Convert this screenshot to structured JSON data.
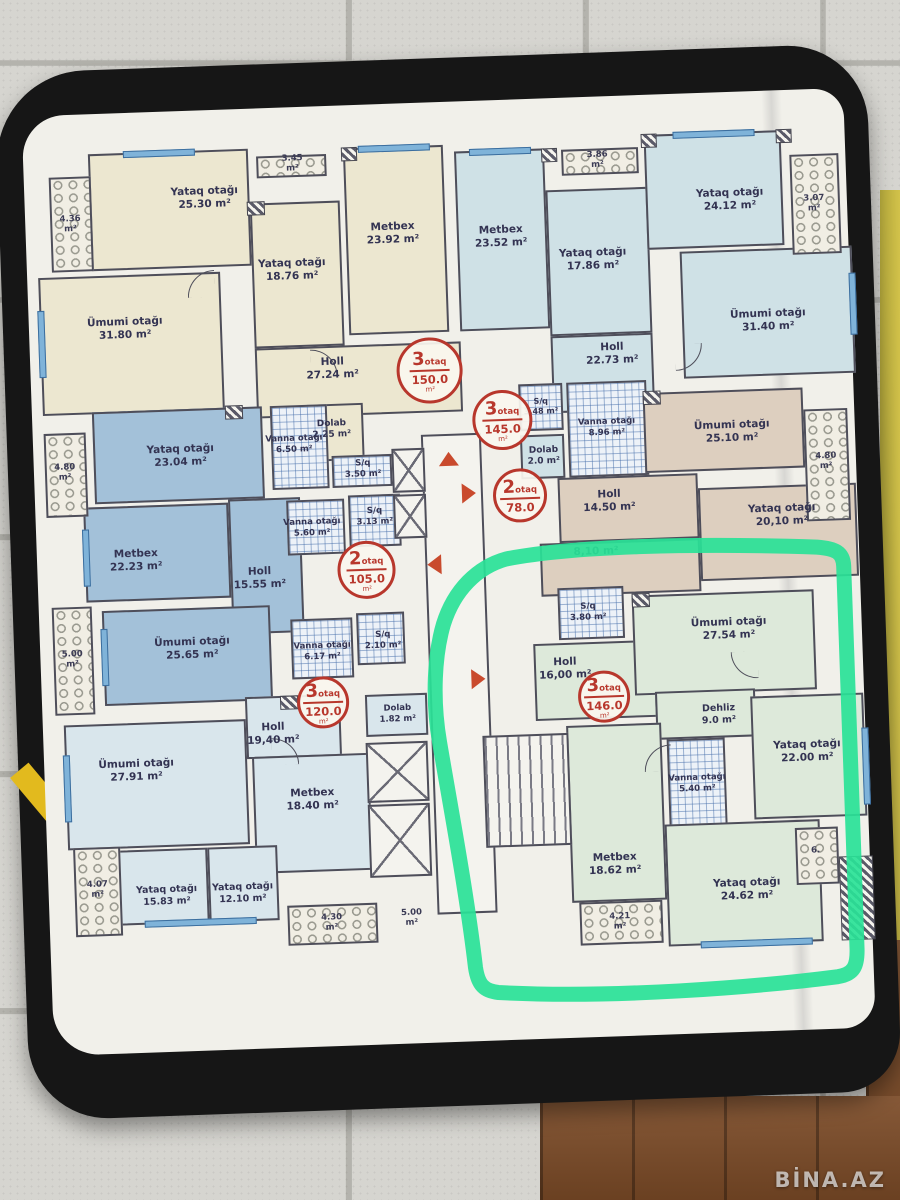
{
  "photo": {
    "watermark": "BİNA.AZ"
  },
  "units": [
    {
      "rooms": "3",
      "suffix": "otaq",
      "area": "150.0",
      "unit": "m²"
    },
    {
      "rooms": "3",
      "suffix": "otaq",
      "area": "145.0",
      "unit": "m²"
    },
    {
      "rooms": "2",
      "suffix": "otaq",
      "area": "78.0",
      "unit": ""
    },
    {
      "rooms": "2",
      "suffix": "otaq",
      "area": "105.0",
      "unit": "m²"
    },
    {
      "rooms": "3",
      "suffix": "otaq",
      "area": "120.0",
      "unit": "m²"
    },
    {
      "rooms": "3",
      "suffix": "otaq",
      "area": "146.0",
      "unit": "m²"
    }
  ],
  "rooms": [
    {
      "name": "Yataq otağı",
      "area": "25.30 m²"
    },
    {
      "name": "Ümumi otağı",
      "area": "31.80 m²"
    },
    {
      "name": "Yataq otağı",
      "area": "18.76 m²"
    },
    {
      "name": "Metbex",
      "area": "23.92 m²"
    },
    {
      "name": "Holl",
      "area": "27.24 m²"
    },
    {
      "name": "Dolab",
      "area": "2.25 m²"
    },
    {
      "name": "S/q",
      "area": "3.50 m²"
    },
    {
      "name": "Vanna otağı",
      "area": "6.50 m²"
    },
    {
      "name": "Metbex",
      "area": "23.52 m²"
    },
    {
      "name": "Yataq otağı",
      "area": "17.86 m²"
    },
    {
      "name": "Holl",
      "area": "22.73 m²"
    },
    {
      "name": "S/q",
      "area": "3.48 m²"
    },
    {
      "name": "Vanna otağı",
      "area": "8.96 m²"
    },
    {
      "name": "Dolab",
      "area": "2.0 m²"
    },
    {
      "name": "Yataq otağı",
      "area": "24.12 m²"
    },
    {
      "name": "Ümumi otağı",
      "area": "31.40 m²"
    },
    {
      "name": "Ümumi otağı",
      "area": "25.10 m²"
    },
    {
      "name": "Holl",
      "area": "14.50 m²"
    },
    {
      "name": "Yataq otağı",
      "area": "20,10 m²"
    },
    {
      "name": "",
      "area": "8,10 m²"
    },
    {
      "name": "Yataq otağı",
      "area": "23.04 m²"
    },
    {
      "name": "Metbex",
      "area": "22.23 m²"
    },
    {
      "name": "Holl",
      "area": "15.55 m²"
    },
    {
      "name": "Ümumi otağı",
      "area": "25.65 m²"
    },
    {
      "name": "Vanna otağı",
      "area": "5.60 m²"
    },
    {
      "name": "S/q",
      "area": "3.13 m²"
    },
    {
      "name": "Vanna otağı",
      "area": "6.17 m²"
    },
    {
      "name": "S/q",
      "area": "2.10 m²"
    },
    {
      "name": "Ümumi otağı",
      "area": "27.91 m²"
    },
    {
      "name": "Holl",
      "area": "19,40 m²"
    },
    {
      "name": "Metbex",
      "area": "18.40 m²"
    },
    {
      "name": "Yataq otağı",
      "area": "15.83 m²"
    },
    {
      "name": "Yataq otağı",
      "area": "12.10 m²"
    },
    {
      "name": "Dolab",
      "area": "1.82 m²"
    },
    {
      "name": "S/q",
      "area": "3.80 m²"
    },
    {
      "name": "Holl",
      "area": "16,00 m²"
    },
    {
      "name": "Ümumi otağı",
      "area": "27.54 m²"
    },
    {
      "name": "Dehliz",
      "area": "9.0 m²"
    },
    {
      "name": "Yataq otağı",
      "area": "22.00 m²"
    },
    {
      "name": "Vanna otağı",
      "area": "5.40 m²"
    },
    {
      "name": "Metbex",
      "area": "18.62 m²"
    },
    {
      "name": "Yataq otağı",
      "area": "24.62 m²"
    }
  ],
  "balconies": [
    "4.36 m²",
    "3.45 m²",
    "3.86 m²",
    "3.07 m²",
    "4.80 m²",
    "5.00 m²",
    "4.80 m²",
    "4.07 m²",
    "4.30 m²",
    "5.00 m²",
    "4.21 m²",
    "6."
  ],
  "colors": {
    "marker_green": "#29e297",
    "unit_red": "#b8372c",
    "cream": "#ece7d0",
    "light_blue": "#cfe1e6",
    "blue": "#a3c1d9",
    "tan": "#ddcfbf",
    "pale_blue": "#d9e6ec",
    "green_apt": "#dde9da"
  }
}
